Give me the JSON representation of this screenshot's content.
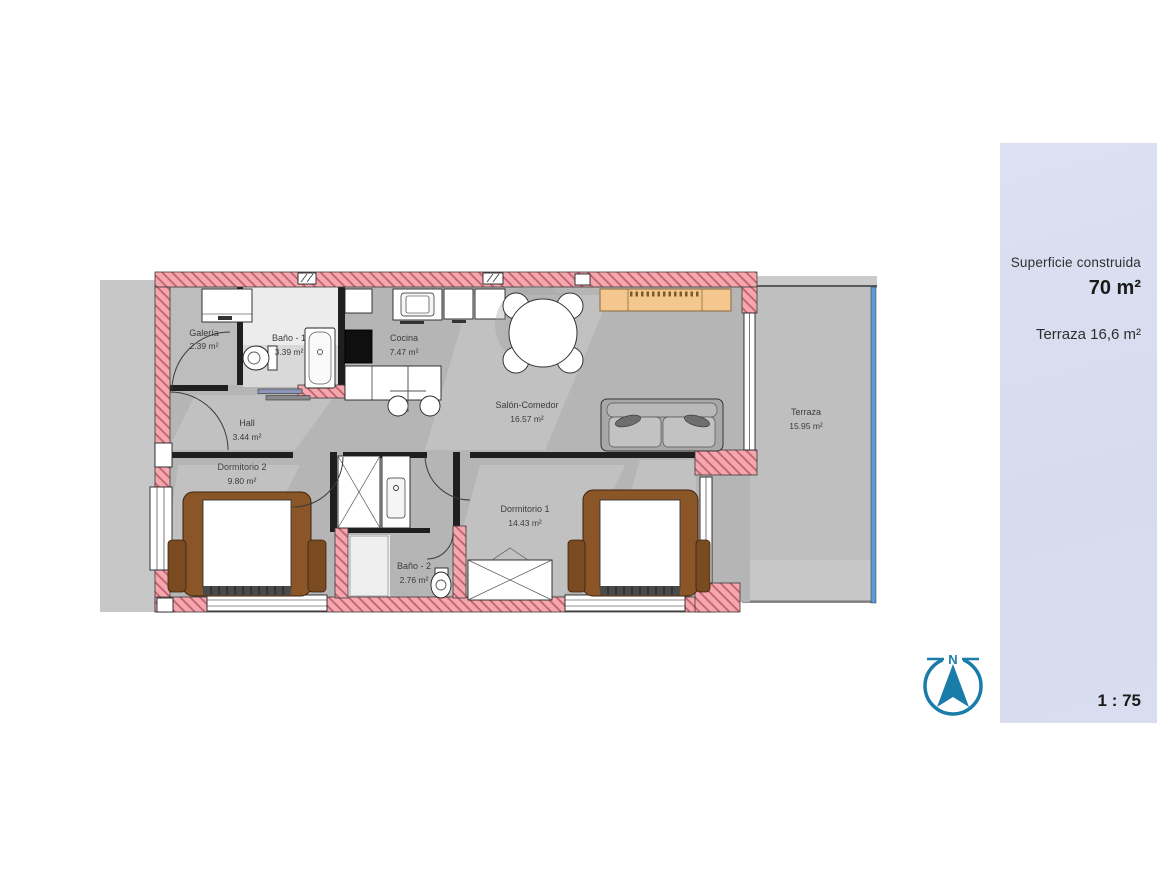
{
  "panel": {
    "surface_label": "Superficie construida",
    "surface_value": "70 m²",
    "terrace_label": "Terraza 16,6 m²",
    "scale_label": "1 : 75",
    "background": "#d9ddef"
  },
  "compass": {
    "north_label": "N",
    "color": "#1a7ca9"
  },
  "rooms": [
    {
      "name": "Galería",
      "area": "2.39 m²"
    },
    {
      "name": "Baño - 1",
      "area": "3.39 m²"
    },
    {
      "name": "Cocina",
      "area": "7.47 m²"
    },
    {
      "name": "Hall",
      "area": "3.44 m²"
    },
    {
      "name": "Salón-Comedor",
      "area": "16.57 m²"
    },
    {
      "name": "Dormitorio 2",
      "area": "9.80 m²"
    },
    {
      "name": "Dormitorio 1",
      "area": "14.43 m²"
    },
    {
      "name": "Baño - 2",
      "area": "2.76 m²"
    },
    {
      "name": "Terraza",
      "area": "15.95 m²"
    }
  ],
  "colors": {
    "wall_pink": "#f4a7ae",
    "wall_hatch": "#c2626c",
    "floor_gray": "#b5b5b5",
    "terrace_gray": "#bfbfbf",
    "exterior_gray": "#c7c7c7",
    "glass_blue": "#5b9bd5",
    "furniture_wood": "#8a5527",
    "sideboard_orange": "#f3c78e",
    "label_text": "#3c3c3c"
  }
}
